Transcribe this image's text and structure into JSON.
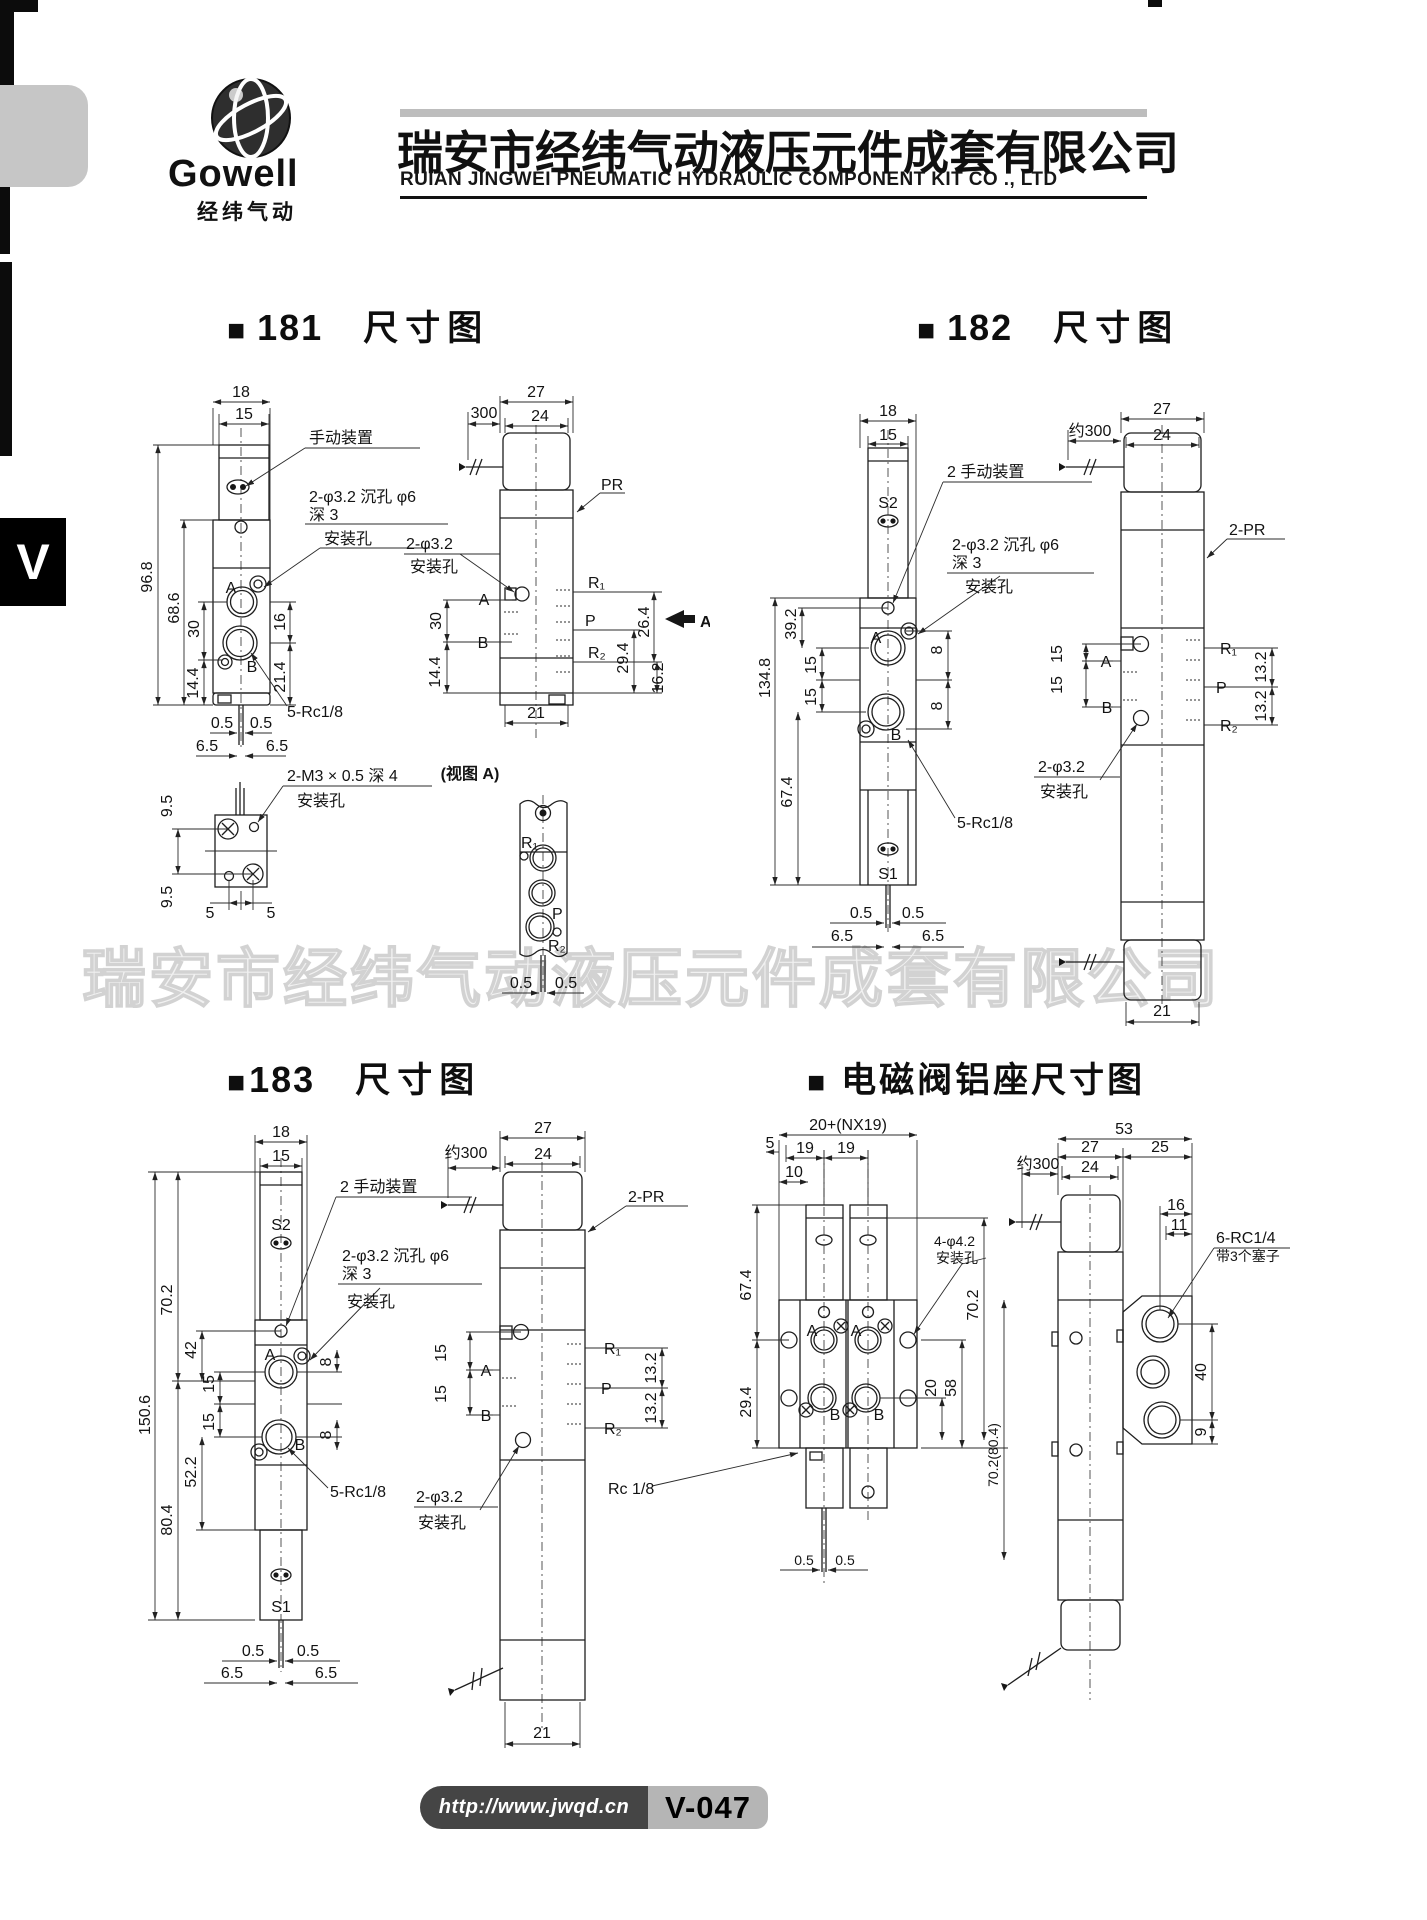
{
  "page": {
    "company_zh": "瑞安市经纬气动液压元件成套有限公司",
    "company_en": "RUIAN JINGWEI PNEUMATIC HYDRAULIC COMPONENT KIT CO ., LTD",
    "logo_text": "Gowell",
    "logo_sub": "经纬气动",
    "side_tab": "V",
    "watermark": "瑞安市经纬气动液压元件成套有限公司",
    "footer_url": "http://www.jwqd.cn",
    "footer_page": "V-047"
  },
  "s181": {
    "badge": "■",
    "number": "181",
    "caption": "尺寸图",
    "front": {
      "d18": "18",
      "d15": "15",
      "d968": "96.8",
      "d686": "68.6",
      "d30": "30",
      "d144": "14.4",
      "d16": "16",
      "d214": "21.4",
      "d05a": "0.5",
      "d05b": "0.5",
      "d65a": "6.5",
      "d65b": "6.5",
      "pa": "A",
      "pb": "B",
      "lead_manual": "手动装置",
      "lead_hole1": "2-φ3.2 沉孔 φ6",
      "lead_hole2": "深 3",
      "lead_hole3": "安装孔",
      "lead_rc": "5-Rc1/8"
    },
    "bottom": {
      "d95a": "9.5",
      "d95b": "9.5",
      "d5a": "5",
      "d5b": "5",
      "lead1": "2-M3 × 0.5 深 4",
      "lead2": "安装孔"
    },
    "side": {
      "d300": "300",
      "d27": "27",
      "d24": "24",
      "pr": "PR",
      "lead1": "2-φ3.2",
      "lead2": "安装孔",
      "pa": "A",
      "pb": "B",
      "d30": "30",
      "d144": "14.4",
      "r1": "R₁",
      "p": "P",
      "r2": "R₂",
      "d264": "26.4",
      "d294": "29.4",
      "d162": "16.2",
      "d21": "21",
      "view_arrow": "A"
    },
    "viewa": {
      "caption": "(视图 A)",
      "r1": "R₁",
      "p": "P",
      "r2": "R₂",
      "d05a": "0.5",
      "d05b": "0.5"
    }
  },
  "s182": {
    "badge": "■",
    "number": "182",
    "caption": "尺寸图",
    "front": {
      "d18": "18",
      "d15": "15",
      "s2": "S2",
      "lead_manual": "2 手动装置",
      "lead_hole1": "2-φ3.2 沉孔 φ6",
      "lead_hole2": "深 3",
      "lead_hole3": "安装孔",
      "d1348": "134.8",
      "d392": "39.2",
      "d15a": "15",
      "d15b": "15",
      "d674": "67.4",
      "d8a": "8",
      "d8b": "8",
      "pa": "A",
      "pb": "B",
      "lead_rc": "5-Rc1/8",
      "s1": "S1",
      "d05a": "0.5",
      "d05b": "0.5",
      "d65a": "6.5",
      "d65b": "6.5"
    },
    "side": {
      "d300": "约300",
      "d27": "27",
      "d24": "24",
      "pr": "2-PR",
      "d15a": "15",
      "d15b": "15",
      "pa": "A",
      "pb": "B",
      "r1": "R₁",
      "p": "P",
      "r2": "R₂",
      "d132a": "13.2",
      "d132b": "13.2",
      "lead1": "2-φ3.2",
      "lead2": "安装孔",
      "d21": "21"
    }
  },
  "s183": {
    "badge": "■",
    "number": "183",
    "caption": "尺寸图",
    "front": {
      "d18": "18",
      "d15": "15",
      "s2": "S2",
      "lead_manual": "2 手动装置",
      "lead_hole1": "2-φ3.2 沉孔 φ6",
      "lead_hole2": "深 3",
      "lead_hole3": "安装孔",
      "d1506": "150.6",
      "d702": "70.2",
      "d42": "42",
      "d15a": "15",
      "d15b": "15",
      "d522": "52.2",
      "d804": "80.4",
      "d8a": "8",
      "d8b": "8",
      "pa": "A",
      "pb": "B",
      "lead_rc": "5-Rc1/8",
      "s1": "S1",
      "d05a": "0.5",
      "d05b": "0.5",
      "d65a": "6.5",
      "d65b": "6.5"
    },
    "side": {
      "d300": "约300",
      "d27": "27",
      "d24": "24",
      "pr": "2-PR",
      "d15a": "15",
      "d15b": "15",
      "pa": "A",
      "pb": "B",
      "r1": "R₁",
      "p": "P",
      "r2": "R₂",
      "d132a": "13.2",
      "d132b": "13.2",
      "lead1": "2-φ3.2",
      "lead2": "安装孔",
      "d21": "21"
    }
  },
  "sbase": {
    "badge": "■",
    "caption": "电磁阀铝座尺寸图",
    "front": {
      "dtotal": "20+(NX19)",
      "d5": "5",
      "d19a": "19",
      "d19b": "19",
      "d10": "10",
      "d674": "67.4",
      "d294": "29.4",
      "pa1": "A",
      "pa2": "A",
      "pb1": "B",
      "pb2": "B",
      "lead1": "4-φ4.2",
      "lead2": "安装孔",
      "d702": "70.2",
      "d20": "20",
      "d58": "58",
      "d702804": "70.2(80.4)",
      "lead_rc": "Rc 1/8",
      "d05a": "0.5",
      "d05b": "0.5"
    },
    "side": {
      "d53": "53",
      "d27": "27",
      "d25": "25",
      "d24": "24",
      "d300": "约300",
      "d16": "16",
      "d11": "11",
      "lead1": "6-RC1/4",
      "lead2": "带3个塞子",
      "d40": "40",
      "d9": "9"
    }
  }
}
